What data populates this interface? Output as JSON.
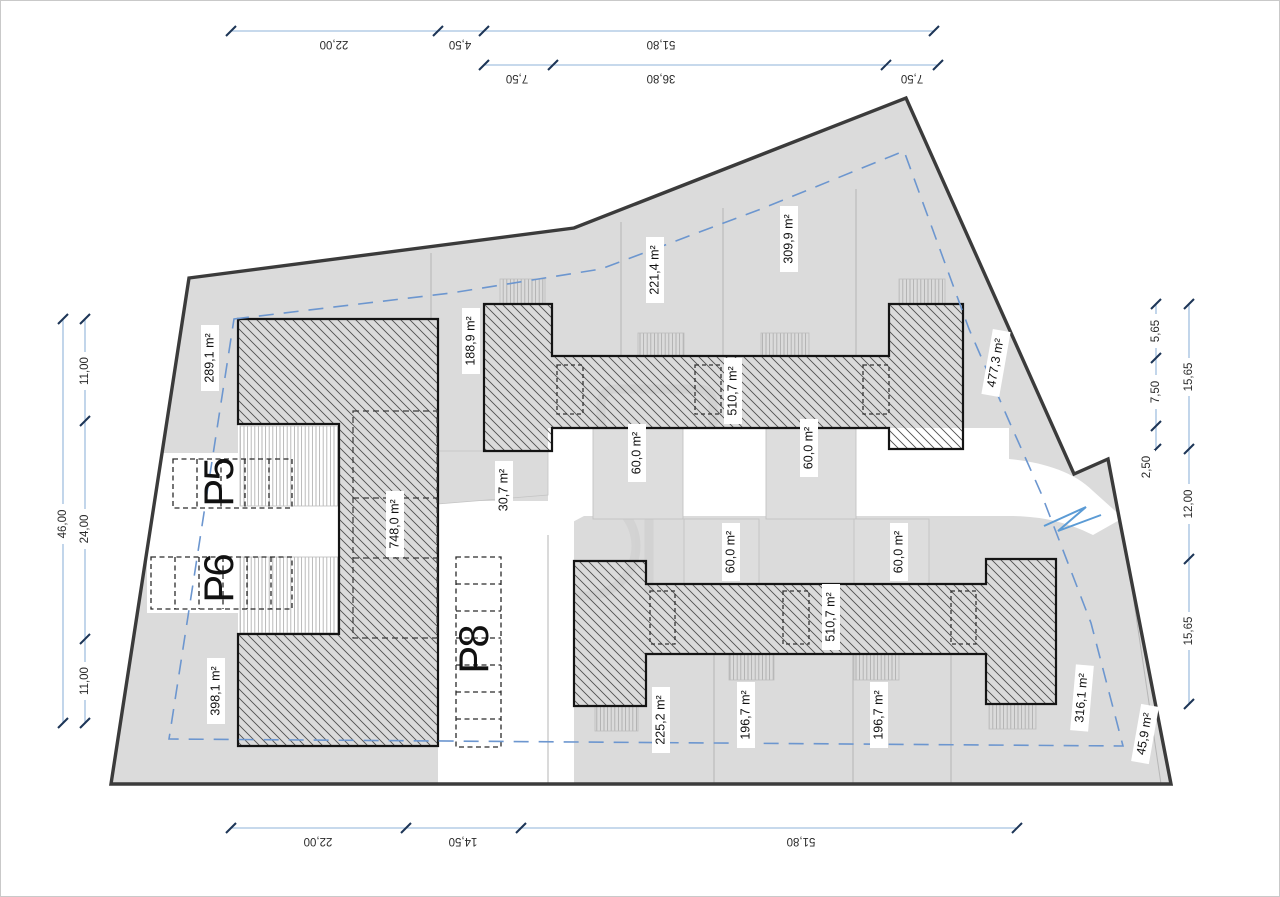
{
  "plan": {
    "dims": {
      "top_row1": [
        "22,00",
        "4,50",
        "51,80"
      ],
      "top_row2": [
        "7,50",
        "36,80",
        "7,50"
      ],
      "bottom": [
        "22,00",
        "14,50",
        "51,80"
      ],
      "left_outer": "46,00",
      "left_inner": [
        "11,00",
        "24,00",
        "11,00"
      ],
      "right_inner": [
        "5,65",
        "7,50",
        "2,50"
      ],
      "right_outer": [
        "15,65",
        "12,00",
        "15,65"
      ]
    },
    "areas": {
      "a289": "289,1 m²",
      "a188": "188,9 m²",
      "a221": "221,4 m²",
      "a309": "309,9 m²",
      "a477": "477,3 m²",
      "a510u": "510,7 m²",
      "a510l": "510,7 m²",
      "a60u1": "60,0 m²",
      "a60u2": "60,0 m²",
      "a60l1": "60,0 m²",
      "a60l2": "60,0 m²",
      "a30": "30,7 m²",
      "a748": "748,0 m²",
      "a398": "398,1 m²",
      "a225": "225,2 m²",
      "a196a": "196,7 m²",
      "a196b": "196,7 m²",
      "a316": "316,1 m²",
      "a45": "45,9 m²"
    },
    "parking": {
      "p5": "P5",
      "p6": "P6",
      "p8": "P8"
    },
    "colors": {
      "site_fill": "#dbdbdb",
      "boundary": "#3b3b3b",
      "dim_line": "#8fb3da",
      "dim_tick": "#1d3557",
      "setback_blue": "#6c96cf",
      "hatch": "#4f4f4f"
    }
  }
}
